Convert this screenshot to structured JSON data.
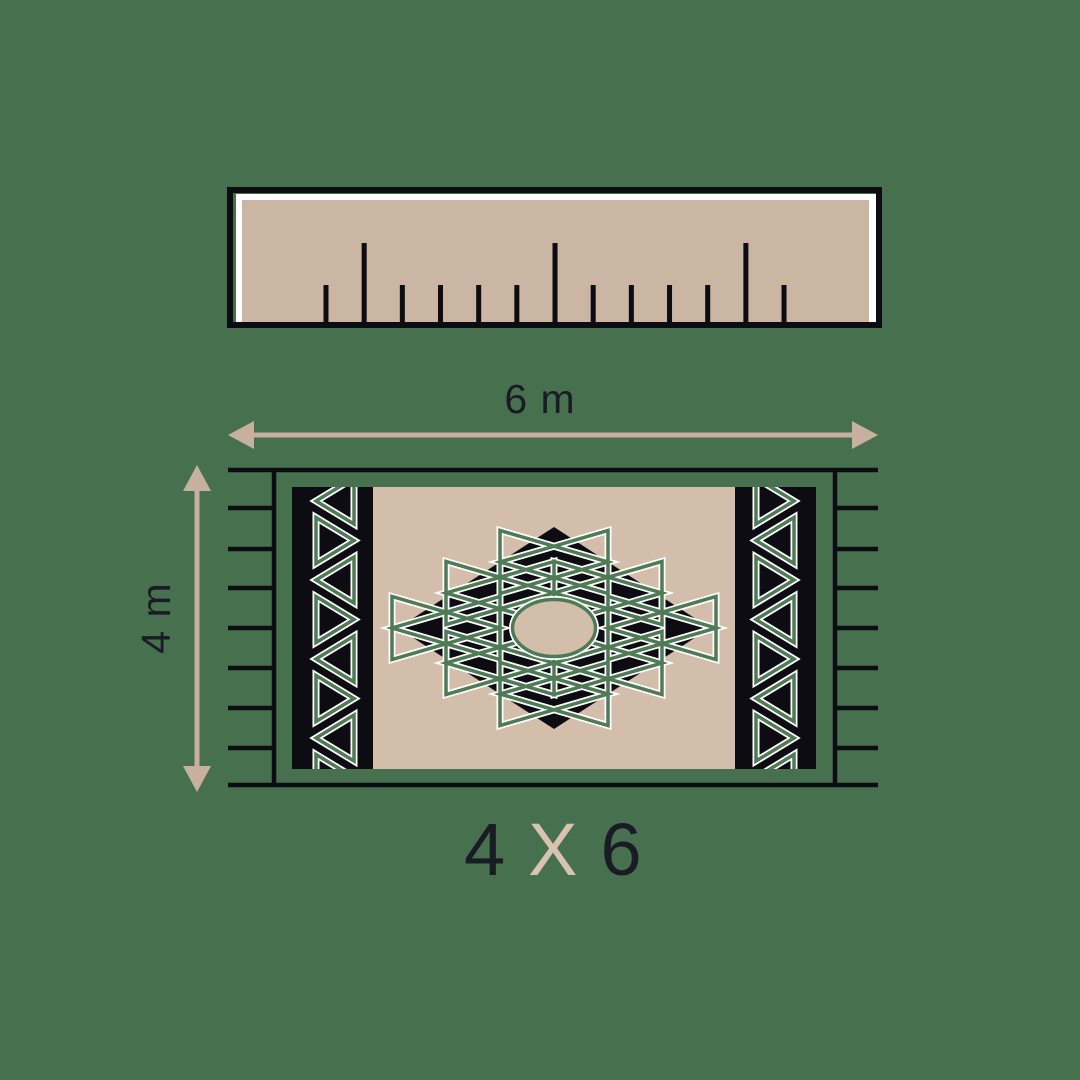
{
  "colors": {
    "background": "#47704F",
    "line_black": "#0C0C12",
    "text_dark": "#1B1B26",
    "ruler_fill": "#CBB5A3",
    "ruler_hairline": "#FFFFFF",
    "arrow_beige": "#C7B19E",
    "carpet_beige": "#D3BEAC",
    "pattern_green": "#4E7B55",
    "pattern_halo": "#FFFFFF",
    "size_label_x_beige": "#D8C3B1"
  },
  "ruler": {
    "x": 227,
    "y": 187,
    "width": 655,
    "height": 141,
    "border_width": 6,
    "fill_inset_white": {
      "x": 236,
      "y": 194,
      "w": 640,
      "h": 130
    },
    "fill_inset_beige": {
      "x": 242,
      "y": 200,
      "w": 627,
      "h": 122
    },
    "tick_base_y": 323,
    "tick_start_x": 326,
    "tick_spacing": 38.17,
    "tick_count": 13,
    "tick_width": 5,
    "short_tick_top_y": 285,
    "tall_tick_top_y": 243,
    "tall_tick_period": 5,
    "tall_tick_offset": 1
  },
  "dimensions": {
    "width_label": "6 m",
    "height_label": "4 m",
    "h_arrow": {
      "x1": 228,
      "x2": 878,
      "y": 435,
      "shaft": 5,
      "head_len": 26,
      "head_half_w": 14
    },
    "v_arrow": {
      "x": 197,
      "y1": 465,
      "y2": 792,
      "shaft": 5,
      "head_len": 26,
      "head_half_w": 14
    },
    "width_label_pos": {
      "x": 540,
      "y": 413,
      "size": 41
    },
    "height_label_pos": {
      "x": 170,
      "y": 618,
      "size": 41
    }
  },
  "rug": {
    "frame": {
      "left_x": 274,
      "right_x": 835,
      "top_y": 470,
      "bottom_y": 785,
      "fringe_left_x": 228,
      "fringe_right_x": 878,
      "line_width": 4.5,
      "fringe_ys": [
        508,
        549,
        588,
        628,
        668,
        708,
        748
      ]
    },
    "carpet": {
      "x": 292,
      "y": 487,
      "w": 524,
      "h": 282
    },
    "bands": {
      "left": {
        "x": 292,
        "w": 81,
        "zig_left": 316,
        "zig_right": 354
      },
      "right": {
        "x": 735,
        "w": 81,
        "zig_left": 756,
        "zig_right": 794
      },
      "zig_center_step": 39.5,
      "zig_back_half": 23,
      "zig_first_center": 501,
      "zig_last_center": 790,
      "stroke_green": 3.5,
      "stroke_halo": 7
    },
    "medallion": {
      "cx": 554,
      "cy": 628,
      "diamond_half_w": 156,
      "diamond_half_h": 101,
      "oval_rx": 41.5,
      "oval_ry": 28.5,
      "bowtie_half_w": 54,
      "bowtie_half_h": 31.5,
      "bowtie_centers": [
        [
          554,
          562
        ],
        [
          608,
          593
        ],
        [
          662,
          628
        ],
        [
          608,
          663
        ],
        [
          554,
          694
        ],
        [
          500,
          663
        ],
        [
          446,
          628
        ],
        [
          500,
          593
        ]
      ],
      "stroke_green": 3.5,
      "stroke_halo": 7
    }
  },
  "size_label": {
    "first": "4",
    "separator": "X",
    "second": "6"
  }
}
